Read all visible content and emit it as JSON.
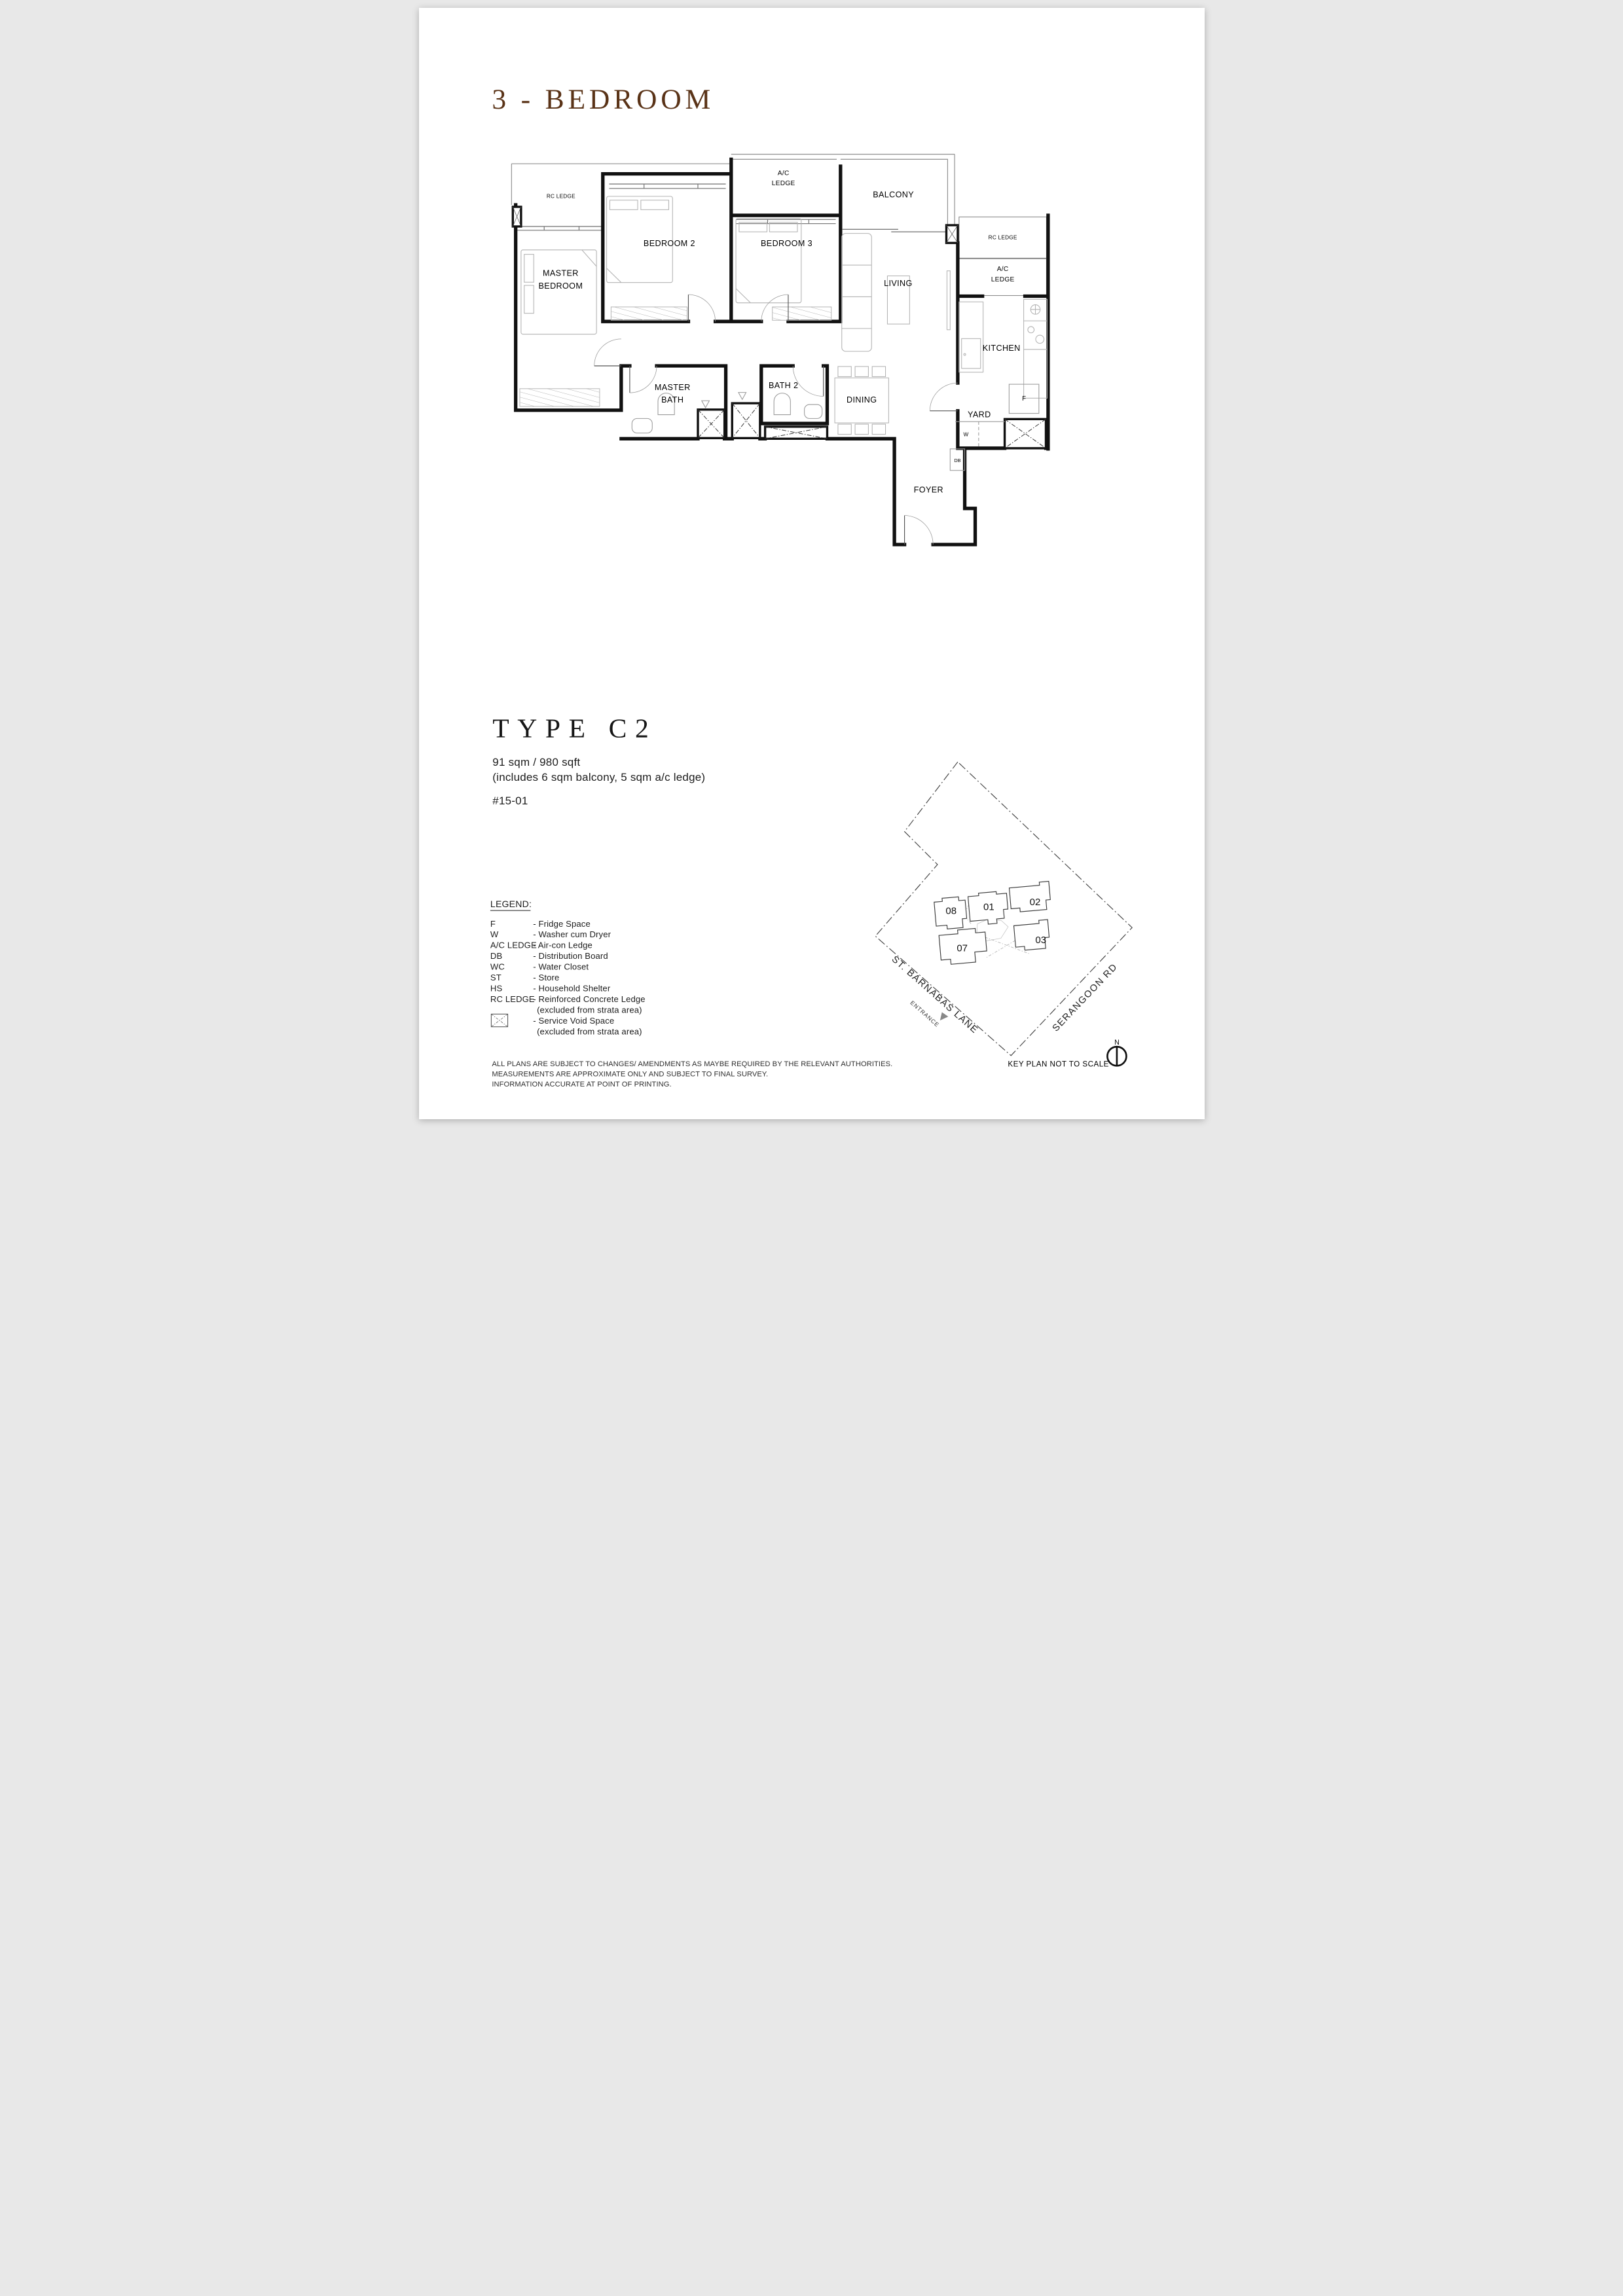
{
  "page": {
    "title": "3 - BEDROOM",
    "accent_color": "#5a3317"
  },
  "unit": {
    "type_heading": "TYPE C2",
    "area": "91 sqm / 980 sqft",
    "area_note": "(includes 6 sqm balcony, 5 sqm a/c ledge)",
    "unit_number": "#15-01"
  },
  "floor_plan": {
    "rooms": {
      "rc_ledge_left": "RC LEDGE",
      "ac_ledge_top_1": "A/C",
      "ac_ledge_top_2": "LEDGE",
      "balcony": "BALCONY",
      "bedroom2": "BEDROOM 2",
      "bedroom3": "BEDROOM 3",
      "master_1": "MASTER",
      "master_2": "BEDROOM",
      "living": "LIVING",
      "rc_ledge_right": "RC LEDGE",
      "ac_ledge_right_1": "A/C",
      "ac_ledge_right_2": "LEDGE",
      "kitchen": "KITCHEN",
      "master_bath_1": "MASTER",
      "master_bath_2": "BATH",
      "bath2": "BATH 2",
      "dining": "DINING",
      "yard": "YARD",
      "washer": "W",
      "db": "DB",
      "fridge": "F",
      "foyer": "FOYER"
    }
  },
  "legend": {
    "heading": "LEGEND:",
    "entries": [
      {
        "key": "F",
        "desc": "- Fridge Space"
      },
      {
        "key": "W",
        "desc": "- Washer cum Dryer"
      },
      {
        "key": "A/C LEDGE",
        "desc": "- Air-con Ledge"
      },
      {
        "key": "DB",
        "desc": "- Distribution Board"
      },
      {
        "key": "WC",
        "desc": "- Water Closet"
      },
      {
        "key": "ST",
        "desc": "- Store"
      },
      {
        "key": "HS",
        "desc": "- Household Shelter"
      },
      {
        "key": "RC LEDGE",
        "desc": "- Reinforced Concrete Ledge",
        "desc2": "(excluded from strata area)"
      },
      {
        "key": "",
        "desc": "- Service Void Space",
        "desc2": "(excluded from strata area)"
      }
    ]
  },
  "key_plan": {
    "note": "KEY PLAN NOT TO SCALE",
    "north_label": "N",
    "entrance_label": "ENTRANCE",
    "streets": {
      "left": "ST. BARNABAS LANE",
      "right": "SERANGOON RD"
    },
    "units": {
      "u08": "08",
      "u01": "01",
      "u02": "02",
      "u07": "07",
      "u03": "03"
    },
    "highlighted_unit": "01"
  },
  "disclaimer": {
    "line1": "ALL PLANS ARE SUBJECT TO CHANGES/ AMENDMENTS AS MAYBE REQUIRED BY THE RELEVANT AUTHORITIES.",
    "line2": "MEASUREMENTS ARE APPROXIMATE ONLY AND SUBJECT TO FINAL SURVEY.",
    "line3": "INFORMATION ACCURATE AT POINT OF PRINTING."
  }
}
